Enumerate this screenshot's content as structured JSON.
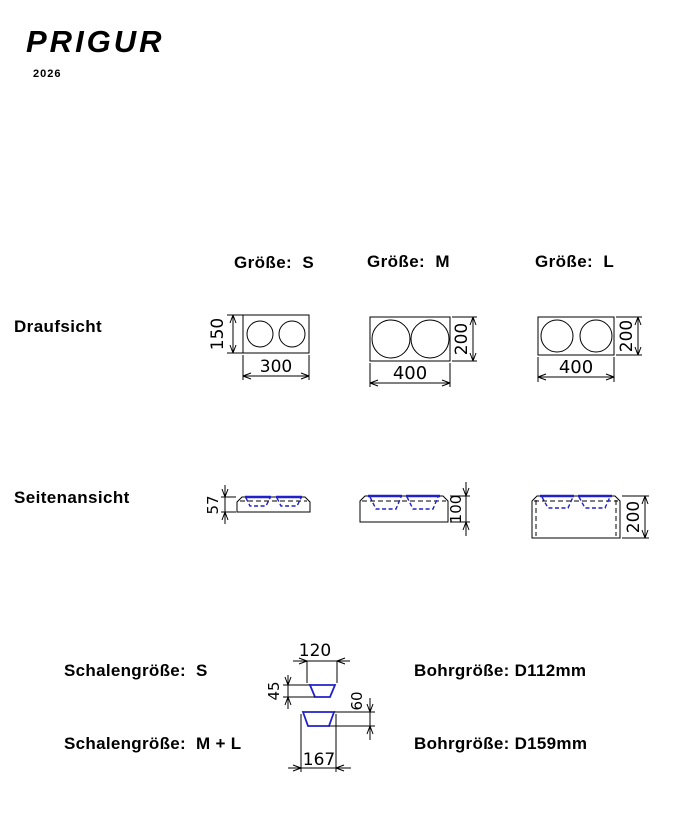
{
  "brand": {
    "logo": "PRIGUR",
    "year": "2026"
  },
  "colors": {
    "bowl_blue": "#2121cc",
    "line": "#000000"
  },
  "headers": {
    "s": "Größe:  S",
    "m": "Größe:  M",
    "l": "Größe:  L"
  },
  "row_labels": {
    "top_view": "Draufsicht",
    "side_view": "Seitenansicht"
  },
  "dims": {
    "top_s_w": "300",
    "top_s_h": "150",
    "top_m_w": "400",
    "top_m_h": "200",
    "top_l_w": "400",
    "top_l_h": "200",
    "side_s_h": "57",
    "side_m_h": "100",
    "side_l_h": "200",
    "bowl_s_w": "120",
    "bowl_s_d": "45",
    "bowl_ml_w": "167",
    "bowl_ml_d": "60"
  },
  "bowls": {
    "s_label": "Schalengröße:  S",
    "ml_label": "Schalengröße:  M + L",
    "bore_s": "Bohrgröße: D112mm",
    "bore_ml": "Bohrgröße: D159mm"
  }
}
